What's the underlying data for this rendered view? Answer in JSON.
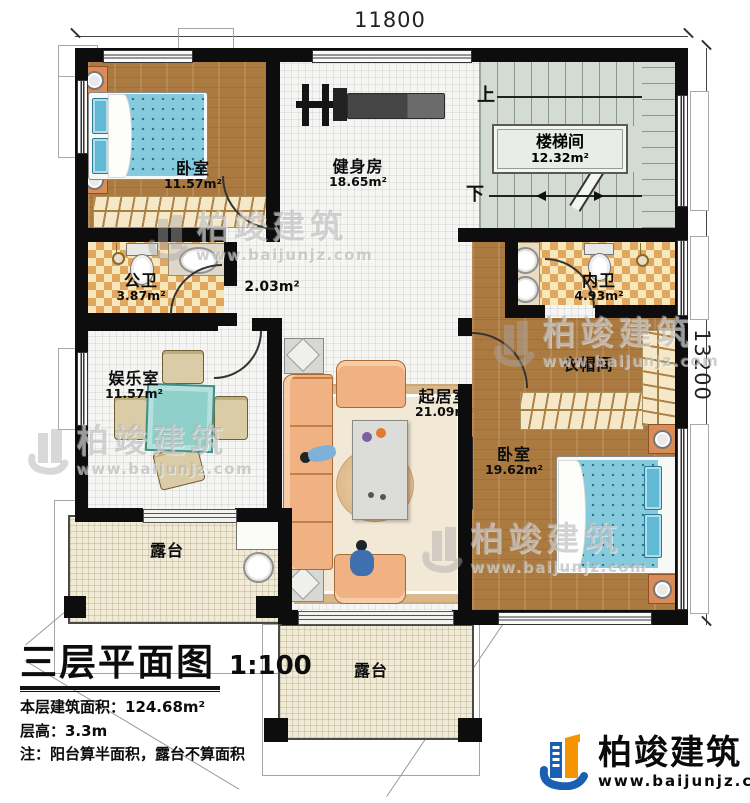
{
  "dimensions": {
    "top": "11800",
    "right": "13200"
  },
  "stairs": {
    "up": "上",
    "down": "下"
  },
  "watermark": {
    "name": "柏竣建筑",
    "url": "www.baijunjz.com"
  },
  "brand": {
    "name": "柏竣建筑",
    "url": "www.baijunjz.com"
  },
  "title_block": {
    "title": "三层平面图",
    "scale": "1:100",
    "area_line": "本层建筑面积：124.68m²",
    "height_line": "层高：3.3m",
    "note_line": "注：阳台算半面积，露台不算面积"
  },
  "rooms": [
    {
      "id": "bedroom-1",
      "name": "卧室",
      "area": "11.57m²"
    },
    {
      "id": "gym",
      "name": "健身房",
      "area": "18.65m²"
    },
    {
      "id": "stairwell",
      "name": "楼梯间",
      "area": "12.32m²"
    },
    {
      "id": "public-bath",
      "name": "公卫",
      "area": "3.87m²"
    },
    {
      "id": "hall",
      "name": "",
      "area": "2.03m²"
    },
    {
      "id": "ensuite-bath",
      "name": "内卫",
      "area": "4.93m²"
    },
    {
      "id": "entertainment",
      "name": "娱乐室",
      "area": "11.57m²"
    },
    {
      "id": "living",
      "name": "起居室",
      "area": "21.09m²"
    },
    {
      "id": "cloakroom",
      "name": "衣帽间",
      "area": ""
    },
    {
      "id": "bedroom-2",
      "name": "卧室",
      "area": "19.62m²"
    },
    {
      "id": "terrace-sw",
      "name": "露台",
      "area": ""
    },
    {
      "id": "terrace-s",
      "name": "露台",
      "area": ""
    }
  ],
  "colors": {
    "wall": "#0d0d0d",
    "wood_floor": "#aa7a40",
    "checker_tile": "#e2a75f",
    "stair_floor": "#d3dbd2",
    "terrace_floor": "#f0ead6",
    "bed_blue": "#86cade",
    "sofa_peach": "#f0b183",
    "brand_blue": "#1a5fb4",
    "brand_orange": "#f59300"
  }
}
